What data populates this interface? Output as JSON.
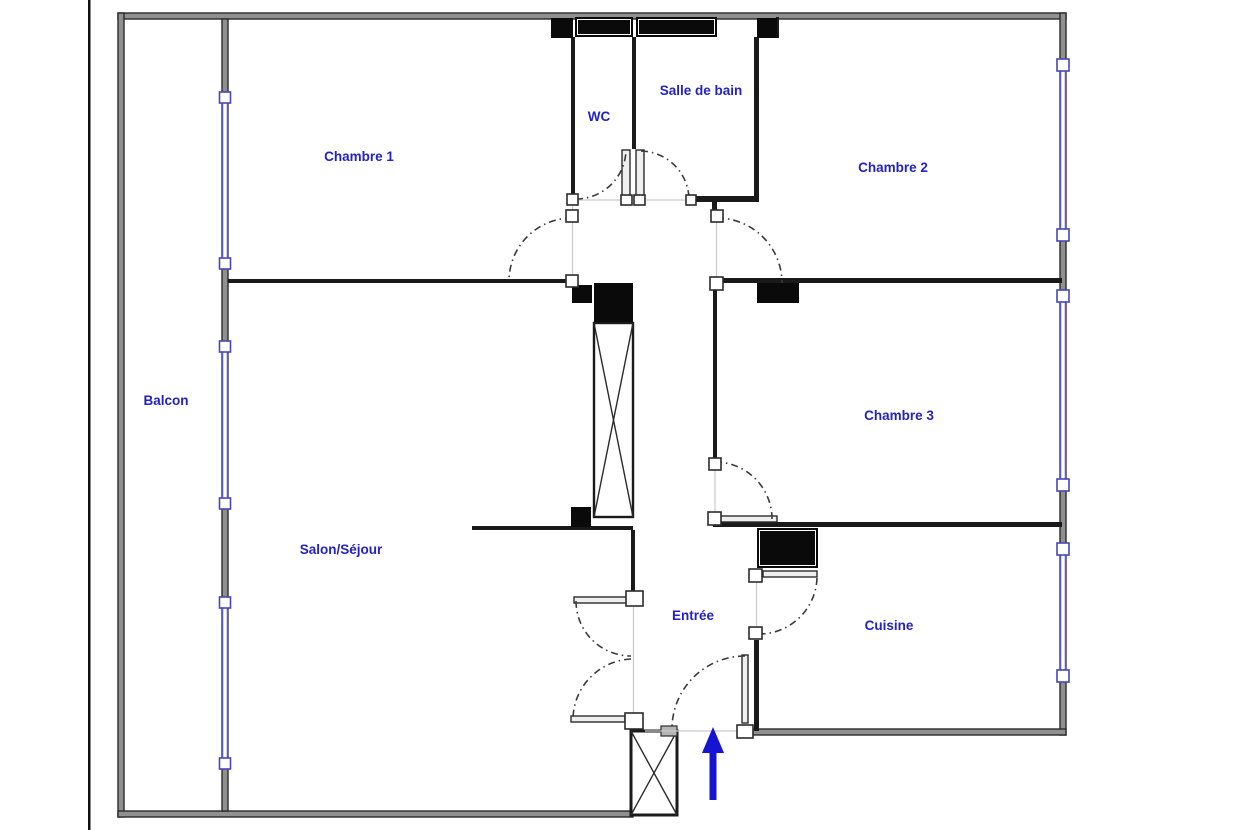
{
  "floor_plan": {
    "title": "Apartment floor plan",
    "rooms": [
      {
        "id": "chambre-1",
        "label": "Chambre 1"
      },
      {
        "id": "wc",
        "label": "WC"
      },
      {
        "id": "salle-de-bain",
        "label": "Salle de bain"
      },
      {
        "id": "chambre-2",
        "label": "Chambre 2"
      },
      {
        "id": "balcon",
        "label": "Balcon"
      },
      {
        "id": "chambre-3",
        "label": "Chambre 3"
      },
      {
        "id": "salon-sejour",
        "label": "Salon/Séjour"
      },
      {
        "id": "entree",
        "label": "Entrée"
      },
      {
        "id": "cuisine",
        "label": "Cuisine"
      }
    ],
    "icons": {
      "entrance_arrow": "entrance-direction-arrow-up"
    },
    "colors": {
      "label_blue": "#2222C8",
      "window_blue": "#5757CE",
      "arrow_blue": "#1414D2",
      "wall_fill_gray": "#909090",
      "wall_dark": "#1a1a1a",
      "opening_gray": "#c9c9c9"
    }
  }
}
